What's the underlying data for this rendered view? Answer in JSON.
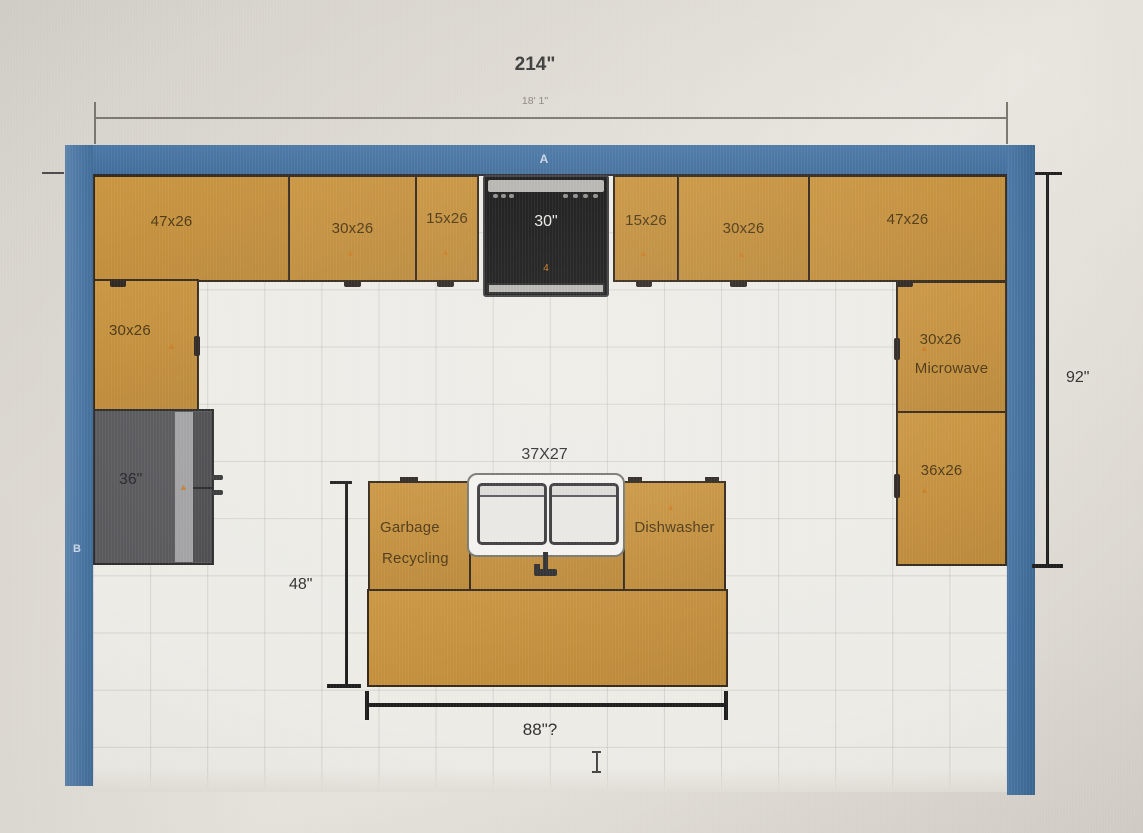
{
  "plan_type": "kitchen-floor-plan",
  "colors": {
    "wall_blue": "#44719E",
    "cabinet_tan": "#C28F3E",
    "cabinet_border": "#34271A",
    "fridge_gray": "#59595C",
    "range_black": "#161616",
    "item_marker_orange": "#CC7A1E",
    "floor": "#ECEBE6"
  },
  "wall_labels": {
    "top": "A",
    "left": "B"
  },
  "dimensions": {
    "overall_width_in": "214\"",
    "overall_width_ft": "18' 1\"",
    "right_depth": "92\"",
    "island_depth": "48\"",
    "island_width": "88\"?",
    "sink": "37X27"
  },
  "top_row": {
    "c1": "47x26",
    "c2": "30x26",
    "c3": "15x26",
    "c4": "15x26",
    "c5": "30x26",
    "c6": "47x26"
  },
  "range": {
    "size": "30\"",
    "marker": "4"
  },
  "left_run": {
    "upper_cabinet": "30x26",
    "fridge_width": "36\""
  },
  "right_run": {
    "upper_cabinet": "30x26",
    "appliance": "Microwave",
    "lower_cabinet": "36x26"
  },
  "island": {
    "left_line1": "Garbage",
    "left_line2": "Recycling",
    "right": "Dishwasher"
  }
}
